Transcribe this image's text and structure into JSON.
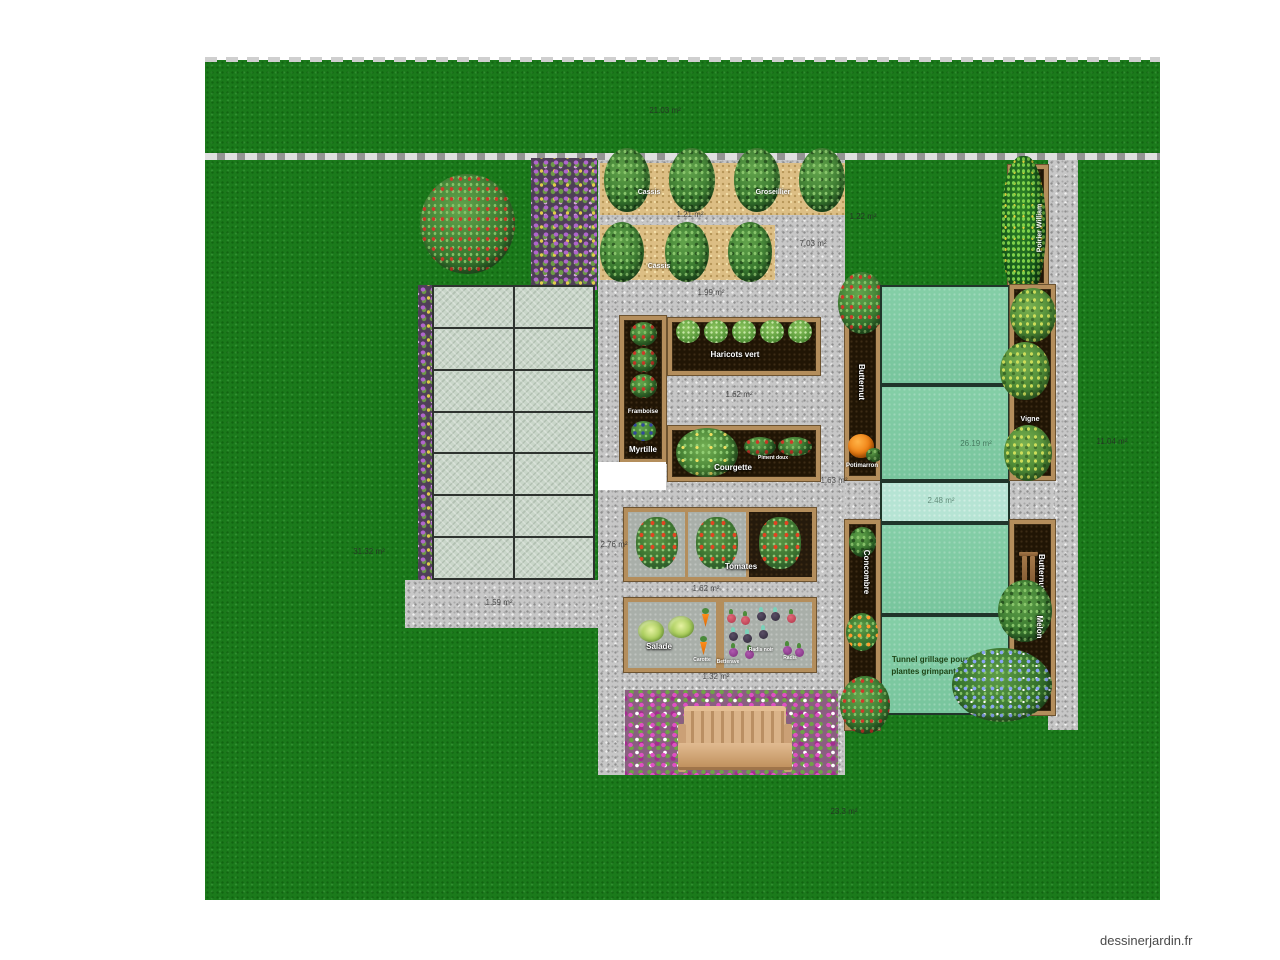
{
  "watermark": "dessinerjardin.fr",
  "colors": {
    "lawn": "#1b7a1b",
    "gravel": "#c7c7c7",
    "mulch": "#dcbe84",
    "soil": "#201505",
    "wood_frame": "#b48e5c",
    "tarp": "#7ec9a2",
    "tarp_light": "#b6e4d4",
    "paving": "#c9d6c9"
  },
  "labels": {
    "cassis": "Cassis",
    "groseillier": "Groseillier",
    "cassis2": "Cassis",
    "haricots_vert": "Haricots vert",
    "framboise": "Framboise",
    "myrtille": "Myrtille",
    "courgette": "Courgette",
    "piment_doux": "Piment doux",
    "tomates": "Tomates",
    "salade": "Salade",
    "carotte": "Carotte",
    "betterave": "Betterave",
    "radis_noir": "Radis noir",
    "radis": "Radis",
    "butternut_upper": "Butternut",
    "potimarron": "Potimarron",
    "vigne": "Vigne",
    "poirier_william": "Poirier William",
    "concombre": "Concombre",
    "butternut_lower": "Butternut",
    "melon": "Melon",
    "tunnel_line1": "Tunnel grillage pour",
    "tunnel_line2": "plantes grimpantes"
  },
  "measurements": {
    "lawn_top": "21.03 m²",
    "path_between_berry_beds": "1.21 m²",
    "lawn_right_of_berry_beds": "1.22 m²",
    "path_right_of_second_berry_bed": "7.03 m²",
    "path_above_central_beds": "1.99 m²",
    "path_between_beans_and_courgette": "1.62 m²",
    "path_right_of_courgette": "1.63 m²",
    "path_left_of_tomatoes": "2.76 m²",
    "path_between_tomatoes_and_salad": "1.62 m²",
    "path_below_salad": "1.32 m²",
    "lawn_left": "31.32 m²",
    "path_below_paving": "1.59 m²",
    "tarp_large": "26.19 m²",
    "tarp_small": "2.48 m²",
    "lawn_right": "11.04 m²",
    "lawn_bottom": "23.3 m²"
  }
}
